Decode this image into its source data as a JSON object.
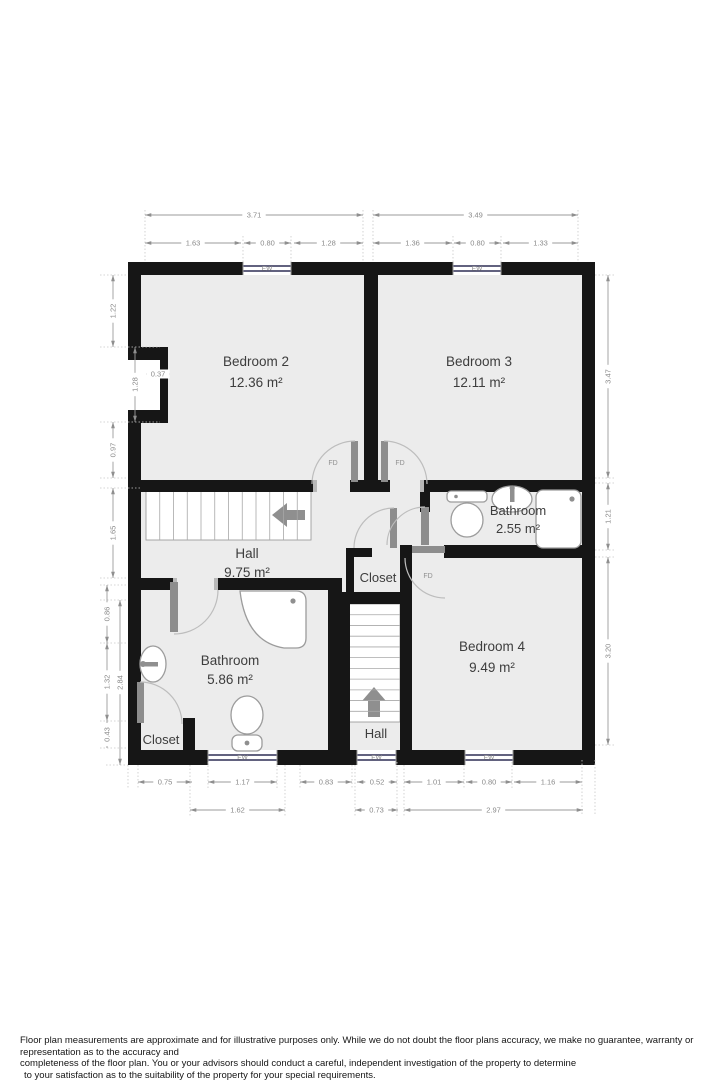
{
  "floorplan": {
    "door_label": "FD",
    "window_label": "EW",
    "rooms": [
      {
        "id": "bedroom2",
        "name": "Bedroom 2",
        "area": "12.36 m²"
      },
      {
        "id": "bedroom3",
        "name": "Bedroom 3",
        "area": "12.11 m²"
      },
      {
        "id": "bathroom-upper",
        "name": "Bathroom",
        "area": "2.55 m²"
      },
      {
        "id": "hall-upper",
        "name": "Hall",
        "area": "9.75 m²"
      },
      {
        "id": "closet-center",
        "name": "Closet",
        "area": ""
      },
      {
        "id": "bedroom4",
        "name": "Bedroom 4",
        "area": "9.49 m²"
      },
      {
        "id": "bathroom-lower",
        "name": "Bathroom",
        "area": "5.86 m²"
      },
      {
        "id": "closet-corner",
        "name": "Closet",
        "area": ""
      },
      {
        "id": "hall-lower",
        "name": "Hall",
        "area": ""
      }
    ],
    "dimensions": {
      "top": [
        {
          "v": "3.71",
          "x1": 145,
          "y1": 215,
          "x2": 363,
          "y2": 215
        },
        {
          "v": "3.49",
          "x1": 373,
          "y1": 215,
          "x2": 578,
          "y2": 215
        },
        {
          "v": "1.63",
          "x1": 145,
          "y1": 243,
          "x2": 241,
          "y2": 243
        },
        {
          "v": "0.80",
          "x1": 244,
          "y1": 243,
          "x2": 291,
          "y2": 243
        },
        {
          "v": "1.28",
          "x1": 294,
          "y1": 243,
          "x2": 363,
          "y2": 243
        },
        {
          "v": "1.36",
          "x1": 373,
          "y1": 243,
          "x2": 452,
          "y2": 243
        },
        {
          "v": "0.80",
          "x1": 454,
          "y1": 243,
          "x2": 501,
          "y2": 243
        },
        {
          "v": "1.33",
          "x1": 503,
          "y1": 243,
          "x2": 578,
          "y2": 243
        }
      ],
      "left": [
        {
          "v": "1.22",
          "x1": 113,
          "y1": 275,
          "x2": 113,
          "y2": 347
        },
        {
          "v": "1.28",
          "x1": 135,
          "y1": 347,
          "x2": 135,
          "y2": 422
        },
        {
          "v": "0.37",
          "x1": 146,
          "y1": 374,
          "x2": 170,
          "y2": 374
        },
        {
          "v": "0.97",
          "x1": 113,
          "y1": 422,
          "x2": 113,
          "y2": 478
        },
        {
          "v": "1.65",
          "x1": 113,
          "y1": 488,
          "x2": 113,
          "y2": 578
        },
        {
          "v": "0.86",
          "x1": 107,
          "y1": 585,
          "x2": 107,
          "y2": 643
        },
        {
          "v": "2.84",
          "x1": 120,
          "y1": 600,
          "x2": 120,
          "y2": 765
        },
        {
          "v": "1.32",
          "x1": 107,
          "y1": 643,
          "x2": 107,
          "y2": 721
        },
        {
          "v": "0.43",
          "x1": 107,
          "y1": 721,
          "x2": 107,
          "y2": 748
        }
      ],
      "right": [
        {
          "v": "3.47",
          "x1": 608,
          "y1": 275,
          "x2": 608,
          "y2": 478
        },
        {
          "v": "1.21",
          "x1": 608,
          "y1": 483,
          "x2": 608,
          "y2": 550
        },
        {
          "v": "3.20",
          "x1": 608,
          "y1": 557,
          "x2": 608,
          "y2": 745
        }
      ],
      "bottom": [
        {
          "v": "0.75",
          "x1": 138,
          "y1": 782,
          "x2": 192,
          "y2": 782
        },
        {
          "v": "1.17",
          "x1": 208,
          "y1": 782,
          "x2": 277,
          "y2": 782
        },
        {
          "v": "0.83",
          "x1": 300,
          "y1": 782,
          "x2": 352,
          "y2": 782
        },
        {
          "v": "0.52",
          "x1": 357,
          "y1": 782,
          "x2": 397,
          "y2": 782
        },
        {
          "v": "1.01",
          "x1": 404,
          "y1": 782,
          "x2": 464,
          "y2": 782
        },
        {
          "v": "0.80",
          "x1": 466,
          "y1": 782,
          "x2": 512,
          "y2": 782
        },
        {
          "v": "1.16",
          "x1": 514,
          "y1": 782,
          "x2": 582,
          "y2": 782
        },
        {
          "v": "1.62",
          "x1": 190,
          "y1": 810,
          "x2": 285,
          "y2": 810
        },
        {
          "v": "0.73",
          "x1": 355,
          "y1": 810,
          "x2": 398,
          "y2": 810
        },
        {
          "v": "2.97",
          "x1": 404,
          "y1": 810,
          "x2": 583,
          "y2": 810
        }
      ]
    }
  },
  "disclaimer": {
    "lines": [
      "Floor plan measurements are approximate and for illustrative purposes only. While we do not doubt the floor plans accuracy, we make no guarantee, warranty or representation as to the accuracy and",
      "completeness of the floor plan. You or your advisors should conduct a careful, independent investigation of the property to determine",
      "to your satisfaction as to the suitability of the property for your special requirements."
    ]
  },
  "colors": {
    "wall": "#161616",
    "room_fill": "#ececec",
    "window_line": "#2f2f55",
    "dimension_line": "#9b9b9b",
    "dimension_text": "#8a8a8a"
  }
}
